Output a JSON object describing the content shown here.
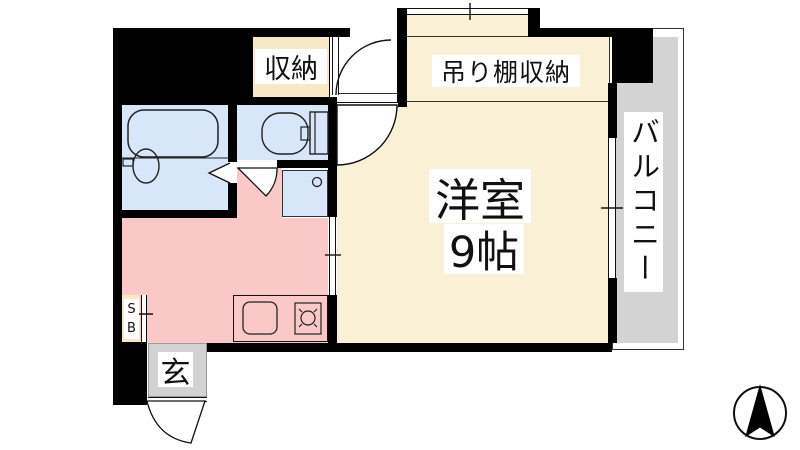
{
  "floorplan": {
    "type": "japanese-apartment-floor-plan",
    "rooms": {
      "closet": {
        "label": "収納"
      },
      "hanging_shelf_storage": {
        "label": "吊り棚収納"
      },
      "western_room": {
        "name": "洋室",
        "size": "9帖"
      },
      "balcony": {
        "label": "バルコニー"
      },
      "entrance": {
        "label": "玄"
      },
      "shoe_box": {
        "label": "SB"
      },
      "bathroom": {
        "fixtures": [
          "bathtub",
          "wash-basin"
        ]
      },
      "toilet": {
        "fixtures": [
          "toilet"
        ]
      },
      "kitchen": {
        "fixtures": [
          "sink",
          "stove",
          "washing-machine-space"
        ]
      }
    },
    "compass": {
      "arrow": "up"
    },
    "colors": {
      "wall": "#000000",
      "room_floor": "#FAF0D6",
      "closet_floor": "#F7E9C5",
      "kitchen_floor": "#FAC8C7",
      "bath_fixture_floor": "#D7E6F8",
      "balcony_floor": "#D3D3D3",
      "entrance_floor": "#D2D2D2",
      "label_background": "#FFFFFF"
    }
  }
}
